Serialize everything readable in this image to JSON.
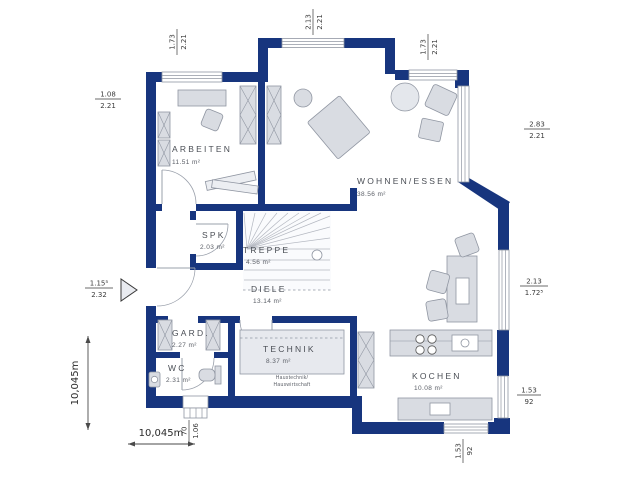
{
  "plan": {
    "rooms": {
      "arbeiten": {
        "name": "ARBEITEN",
        "area": "11.51 m²"
      },
      "wohnen_essen": {
        "name": "WOHNEN/ESSEN",
        "area": "38.56 m²"
      },
      "spk": {
        "name": "SPK",
        "area": "2.03 m²"
      },
      "treppe": {
        "name": "TREPPE",
        "area": "4.56 m²"
      },
      "diele": {
        "name": "DIELE",
        "area": "13.14 m²"
      },
      "gard": {
        "name": "GARD.",
        "area": "2.27 m²"
      },
      "wc": {
        "name": "WC",
        "area": "2.31 m²"
      },
      "technik": {
        "name": "TECHNIK",
        "area": "8.37 m²",
        "note_line1": "Haustechnik/",
        "note_line2": "Hauswirtschaft"
      },
      "kochen": {
        "name": "KOCHEN",
        "area": "10.08 m²"
      }
    },
    "dimensions": {
      "top_left": {
        "num": "1.73",
        "den": "2.21"
      },
      "top_center": {
        "num": "2.13",
        "den": "2.21"
      },
      "top_right": {
        "num": "1.73",
        "den": "2.21"
      },
      "left_upper": {
        "num": "1.08",
        "den": "2.21"
      },
      "entrance": {
        "num": "1.15⁵",
        "den": "2.32"
      },
      "right_upper": {
        "num": "2.83",
        "den": "2.21"
      },
      "right_middle": {
        "num": "2.13",
        "den": "1.72⁵"
      },
      "right_lower": {
        "num": "1.53",
        "den": "92"
      },
      "bottom_door": {
        "num": "70",
        "den": "1.06"
      },
      "bottom_right": {
        "num": "1.53",
        "den": "92"
      },
      "total_width": "10,045m",
      "total_height": "10,045m"
    },
    "colors": {
      "wall": "#17357e",
      "furniture": "#d9dce2",
      "stroke": "#9096a2"
    }
  }
}
